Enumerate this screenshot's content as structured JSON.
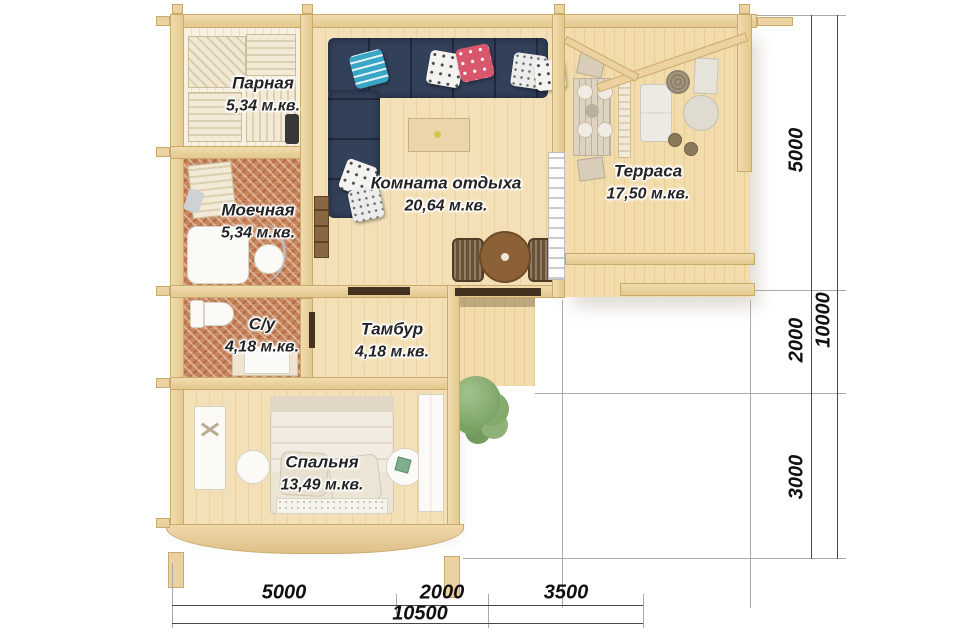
{
  "rooms": [
    {
      "name": "Парная",
      "area": "5,34 м.кв."
    },
    {
      "name": "Моечная",
      "area": "5,34 м.кв."
    },
    {
      "name": "Комната отдыха",
      "area": "20,64 м.кв."
    },
    {
      "name": "Терраса",
      "area": "17,50 м.кв."
    },
    {
      "name": "С/у",
      "area": "4,18 м.кв."
    },
    {
      "name": "Тамбур",
      "area": "4,18 м.кв."
    },
    {
      "name": "Спальня",
      "area": "13,49 м.кв."
    }
  ],
  "dims": {
    "right": [
      "5000",
      "2000",
      "3000"
    ],
    "right_total": "10000",
    "bottom": [
      "5000",
      "2000",
      "3500"
    ],
    "bottom_total": "10500"
  },
  "colors": {
    "wood_wall": "#ecd2a0",
    "wood_floor": "#f4e0b6",
    "mosaic_tile": "#c8835a",
    "sofa_navy": "#2d3a50",
    "pillow_teal": "#3aa6c6",
    "pillow_red": "#d9576c",
    "dimension_line": "#474747"
  }
}
